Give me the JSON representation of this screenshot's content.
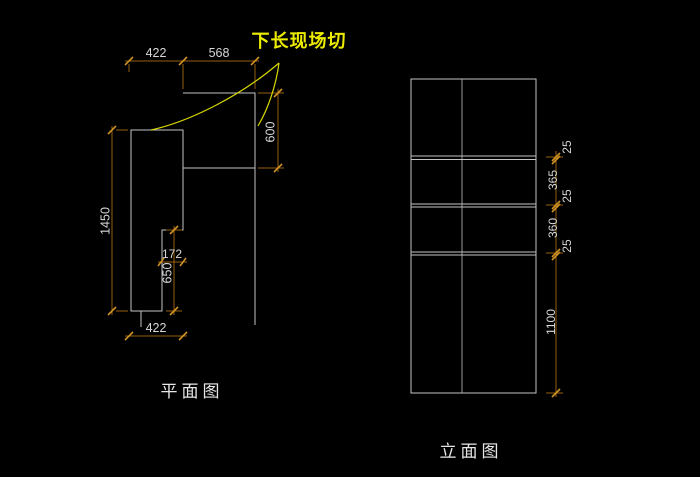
{
  "annotation": {
    "note_label": "下长现场切"
  },
  "plan_view": {
    "title": "平面图",
    "dims": {
      "top_left_width": "422",
      "top_right_width": "568",
      "upper_depth": "600",
      "total_left_length": "1450",
      "step_width": "172",
      "lower_depth": "650",
      "bottom_width": "422"
    }
  },
  "elevation_view": {
    "title": "立面图",
    "dim_segments": [
      "25",
      "365",
      "25",
      "360",
      "25",
      "1100"
    ]
  },
  "colors": {
    "background": "#000000",
    "geometry_line": "#c3c3c3",
    "dimension_line": "#96610e",
    "dimension_tick": "#d19324",
    "dimension_text": "#d8d8d8",
    "annotation_yellow": "#ecec00",
    "title_text": "#e6e6e6"
  }
}
